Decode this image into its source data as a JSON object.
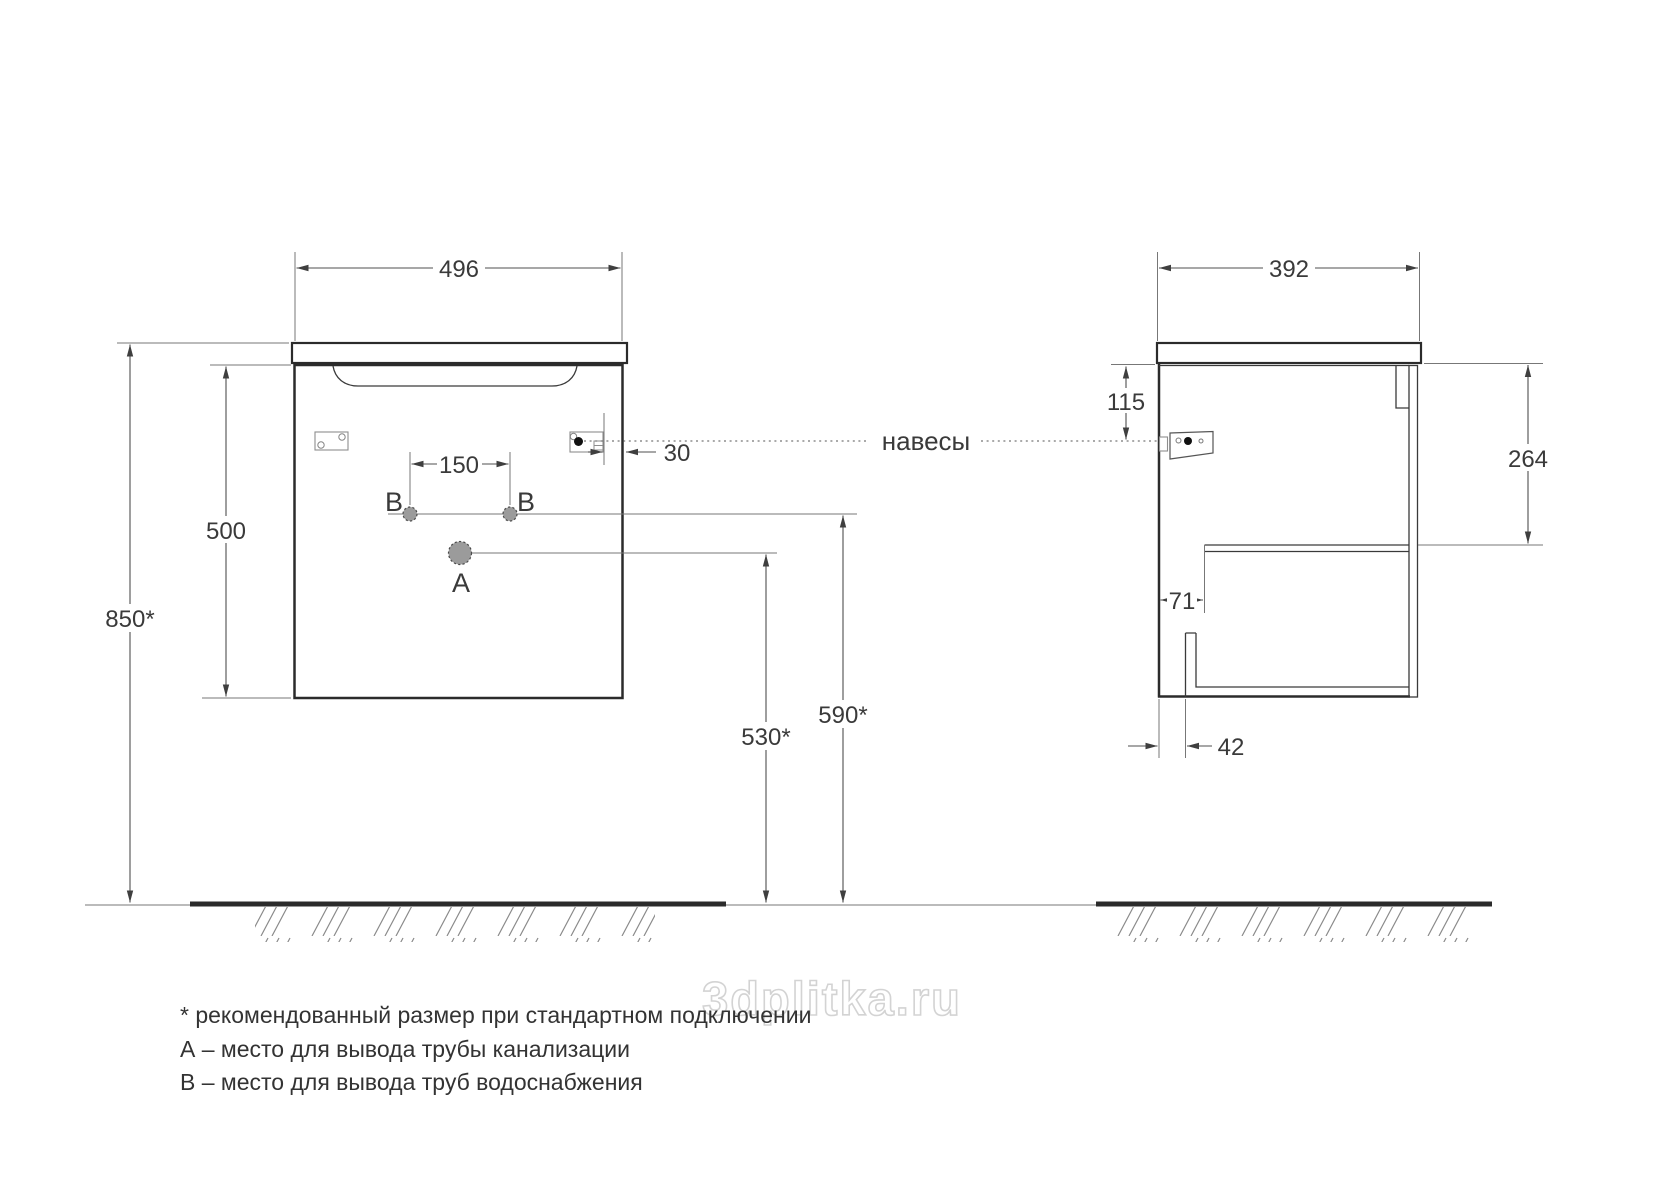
{
  "front_view": {
    "width_dim": "496",
    "height_dim": "500",
    "mount_height_dim": "850*",
    "b_spacing_dim": "150",
    "hanger_inset_dim": "30",
    "a_height_dim": "530*",
    "b_height_dim": "590*",
    "point_a_label": "A",
    "point_b_left_label": "B",
    "point_b_right_label": "B"
  },
  "side_view": {
    "depth_dim": "392",
    "hanger_drop_dim": "115",
    "inner_height_dim": "264",
    "shelf_inset_dim": "71",
    "bottom_inset_dim": "42"
  },
  "annotations": {
    "hangers_label": "навесы"
  },
  "watermark": "3dplitka.ru",
  "footnotes": [
    "* рекомендованный размер при стандартном подключении",
    "А – место для вывода трубы канализации",
    "В – место для вывода труб водоснабжения"
  ]
}
